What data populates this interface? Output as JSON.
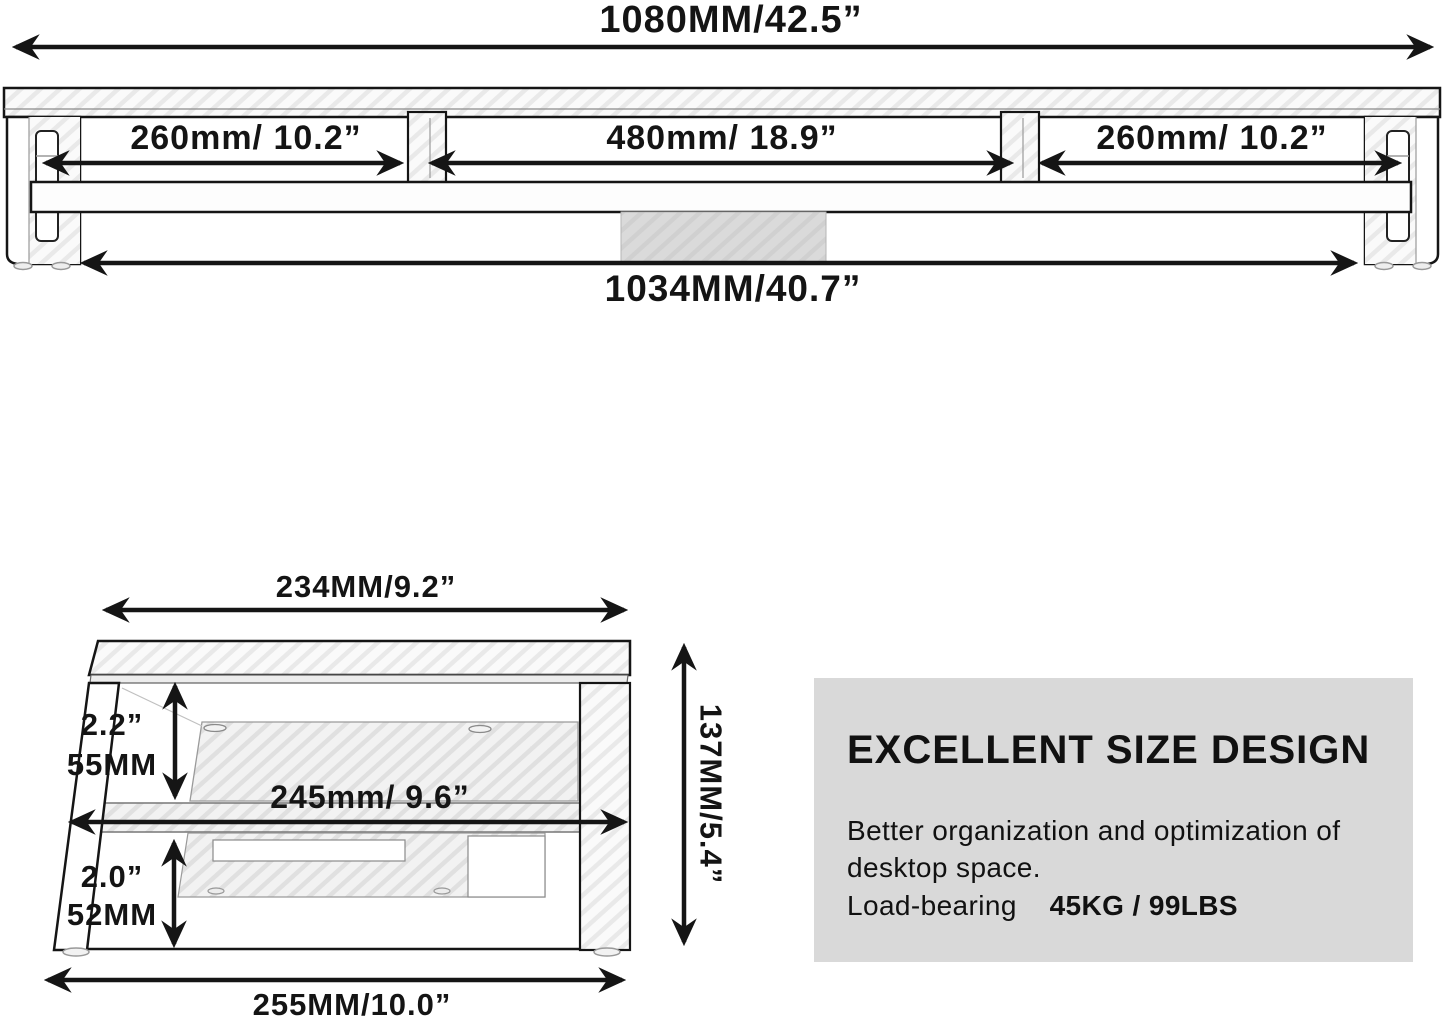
{
  "top_view": {
    "total_width_label": "1080MM/42.5”",
    "left_section_label": "260mm/ 10.2”",
    "middle_section_label": "480mm/ 18.9”",
    "right_section_label": "260mm/ 10.2”",
    "base_width_label": "1034MM/40.7”"
  },
  "side_view": {
    "top_width_label": "234MM/9.2”",
    "upper_gap_inch_label": "2.2”",
    "upper_gap_mm_label": "55MM",
    "middle_width_label": "245mm/ 9.6”",
    "lower_gap_inch_label": "2.0”",
    "lower_gap_mm_label": "52MM",
    "bottom_width_label": "255MM/10.0”",
    "height_label": "137MM/5.4”"
  },
  "info_box": {
    "heading": "EXCELLENT SIZE DESIGN",
    "line1": "Better organization and optimization of",
    "line2": "desktop space.",
    "line3_regular": "Load-bearing",
    "line3_bold": "45KG / 99LBS",
    "background": "#d9d9d9"
  },
  "colors": {
    "line": "#151515",
    "text": "#141414",
    "info_box_background": "#d9d9d9",
    "center_block": "#d9d9d9",
    "hatch_light": "#e9e9e9"
  }
}
